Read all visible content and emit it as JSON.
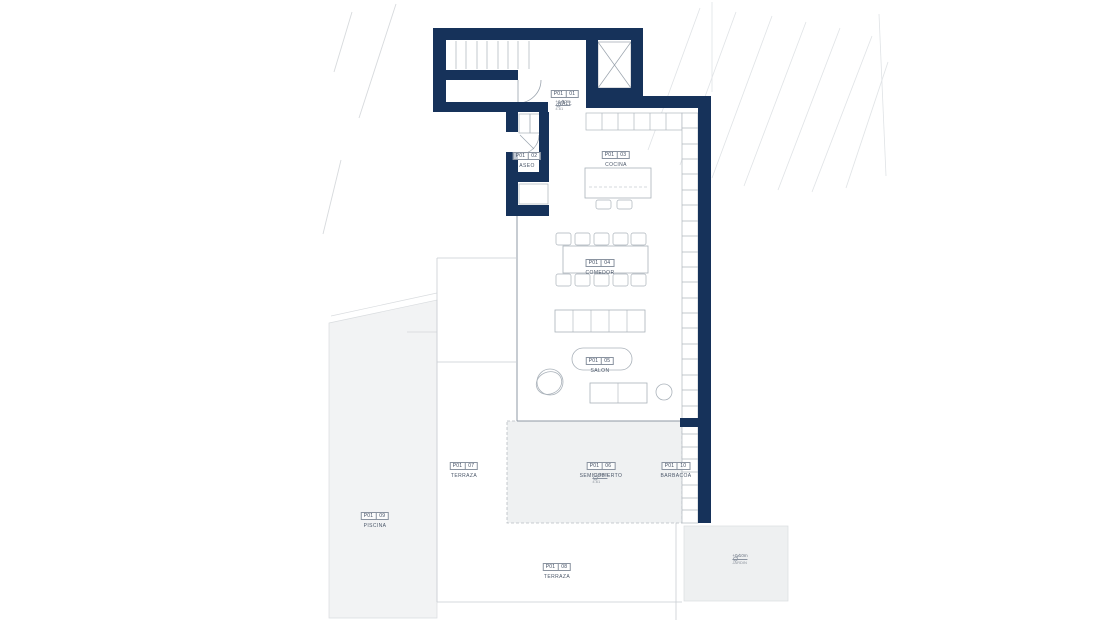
{
  "drawing": {
    "type": "architectural-floor-plan",
    "floor_code": "P01",
    "wall_color": "#16325a",
    "rooms": [
      {
        "plan": "P01",
        "num": "01",
        "name": "HALL"
      },
      {
        "plan": "P01",
        "num": "02",
        "name": "ASEO"
      },
      {
        "plan": "P01",
        "num": "03",
        "name": "COCINA"
      },
      {
        "plan": "P01",
        "num": "04",
        "name": "COMEDOR"
      },
      {
        "plan": "P01",
        "num": "05",
        "name": "SALON"
      },
      {
        "plan": "P01",
        "num": "06",
        "name": "SEMICUBIERTO"
      },
      {
        "plan": "P01",
        "num": "07",
        "name": "TERRAZA"
      },
      {
        "plan": "P01",
        "num": "08",
        "name": "TERRAZA"
      },
      {
        "plan": "P01",
        "num": "09",
        "name": "PISCINA"
      },
      {
        "plan": "P01",
        "num": "10",
        "name": "BARBACOA"
      }
    ],
    "level_markers": [
      {
        "level": "+1.40m",
        "sub": "4.61"
      },
      {
        "level": "+1.40m",
        "sub": "4.61"
      },
      {
        "level": "+0.10m",
        "sub": "JARDIN"
      }
    ]
  }
}
